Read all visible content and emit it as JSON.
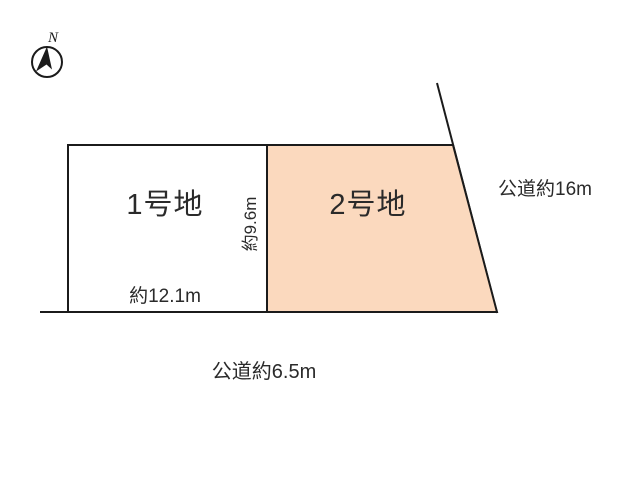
{
  "compass": {
    "north_label": "N"
  },
  "lots": {
    "lot1": {
      "name": "1号地",
      "frontage": "約12.1m",
      "depth": "約9.6m"
    },
    "lot2": {
      "name": "2号地"
    }
  },
  "roads": {
    "right": {
      "label": "公道約16m"
    },
    "bottom": {
      "label": "公道約6.5m"
    }
  },
  "colors": {
    "lot1_fill": "#ffffff",
    "lot2_fill": "#fbd9be",
    "line": "#1b1b1b",
    "text": "#2a2a2a"
  }
}
